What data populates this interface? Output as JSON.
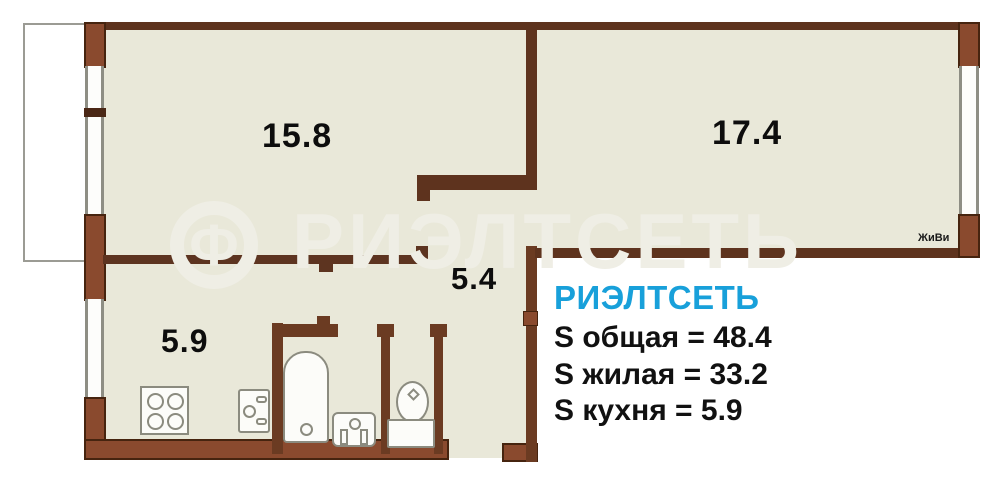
{
  "floorplan": {
    "room_labels": {
      "living_room_1": "15.8",
      "living_room_2": "17.4",
      "hallway": "5.4",
      "kitchen": "5.9"
    },
    "badge": "ЖиВи",
    "watermark": {
      "logo_glyph": "Ф",
      "text": "РИЭЛТСЕТЬ"
    },
    "info_block": {
      "brand": "РИЭЛТСЕТЬ",
      "lines": [
        "S общая = 48.4",
        "S жилая = 33.2",
        "S кухня = 5.9"
      ]
    },
    "colors": {
      "wall_fill": "#8a4a2e",
      "wall_dark": "#5e331e",
      "floor": "#e9e8d9",
      "brand_blue": "#18a0da",
      "watermark": "#efeee5"
    }
  }
}
